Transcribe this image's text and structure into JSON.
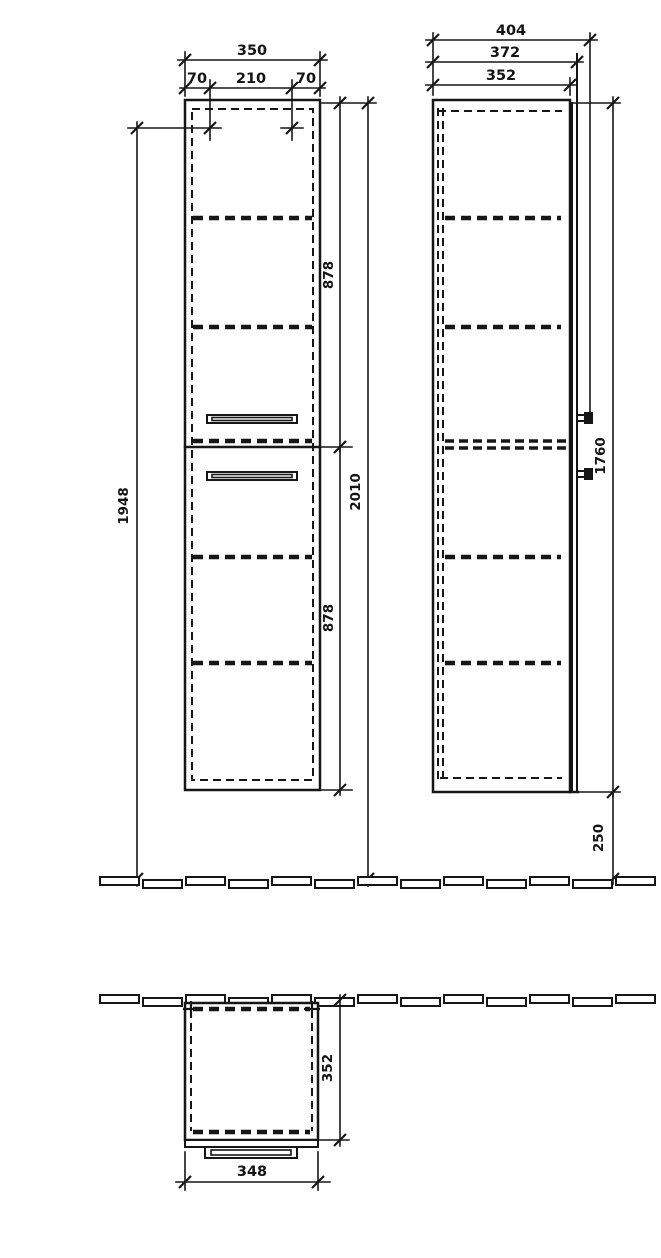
{
  "drawing": {
    "background": "#ffffff",
    "line_color": "#161616"
  },
  "front_view": {
    "width_total": "350",
    "width_left": "70",
    "width_center": "210",
    "width_right": "70",
    "mounting_height": "1948",
    "upper_section": "878",
    "lower_section": "878",
    "overall_height": "2010"
  },
  "side_view": {
    "depth_with_handle": "404",
    "depth_with_door": "372",
    "carcass_depth": "352",
    "carcass_height": "1760",
    "floor_clearance": "250"
  },
  "top_view": {
    "depth": "352",
    "width": "348"
  }
}
